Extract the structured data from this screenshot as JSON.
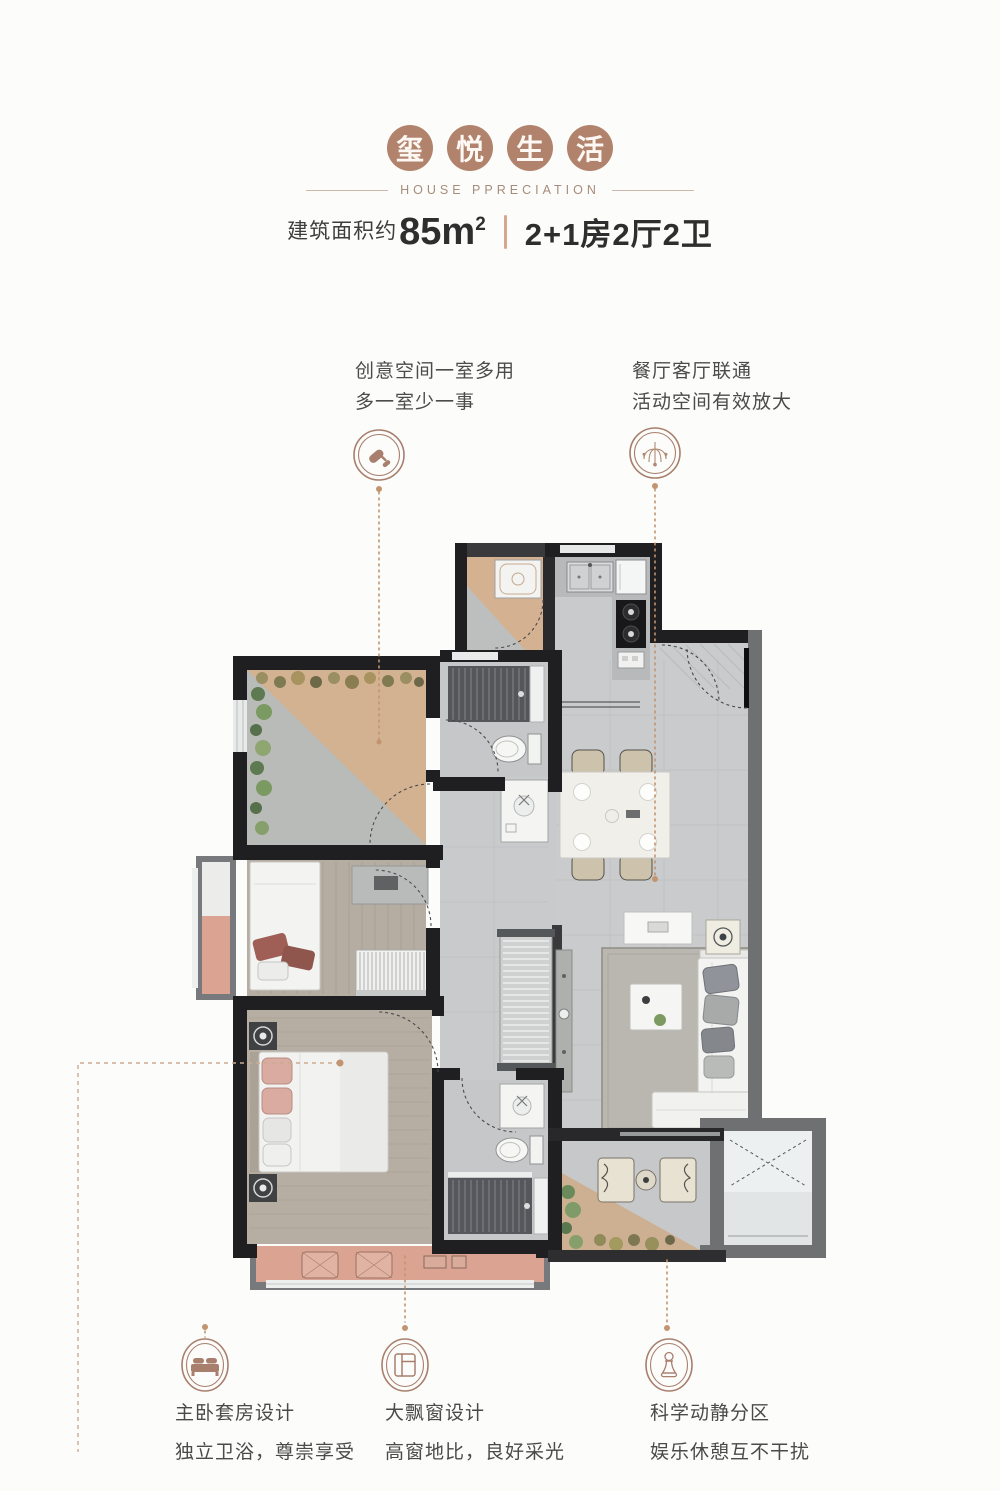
{
  "header": {
    "title_chars": [
      "玺",
      "悦",
      "生",
      "活"
    ],
    "subtitle": "HOUSE PPRECIATION",
    "area_label": "建筑面积约",
    "area_value": "85m",
    "area_superscript": "2",
    "layout_value": "2+1房2厅2卫"
  },
  "callouts": {
    "top_left": {
      "icon": "paint-roller",
      "lines": [
        "创意空间一室多用",
        "多一室少一事"
      ]
    },
    "top_right": {
      "icon": "chandelier",
      "lines": [
        "餐厅客厅联通",
        "活动空间有效放大"
      ]
    },
    "bottom": [
      {
        "icon": "bed",
        "title": "主卧套房设计",
        "desc": "独立卫浴，尊崇享受"
      },
      {
        "icon": "bay-window",
        "title": "大飘窗设计",
        "desc": "高窗地比，良好采光"
      },
      {
        "icon": "chess-pawn",
        "title": "科学动静分区",
        "desc": "娱乐休憩互不干扰"
      }
    ]
  },
  "colors": {
    "accent": "#a87f6c",
    "badge": "#b2836c",
    "text_dark": "#2e2e2e",
    "text_body": "#4b4b4b",
    "leader": "#c2946f",
    "wall": "#1f1f21",
    "wall_gray": "#6e7072",
    "floor_tile": "#c9cbcc",
    "floor_wood": "#b5ada1",
    "floor_tan": "#d3b191",
    "bay_window": "#dba492",
    "plant_green": "#7a9a62",
    "shower": "#54575a"
  }
}
